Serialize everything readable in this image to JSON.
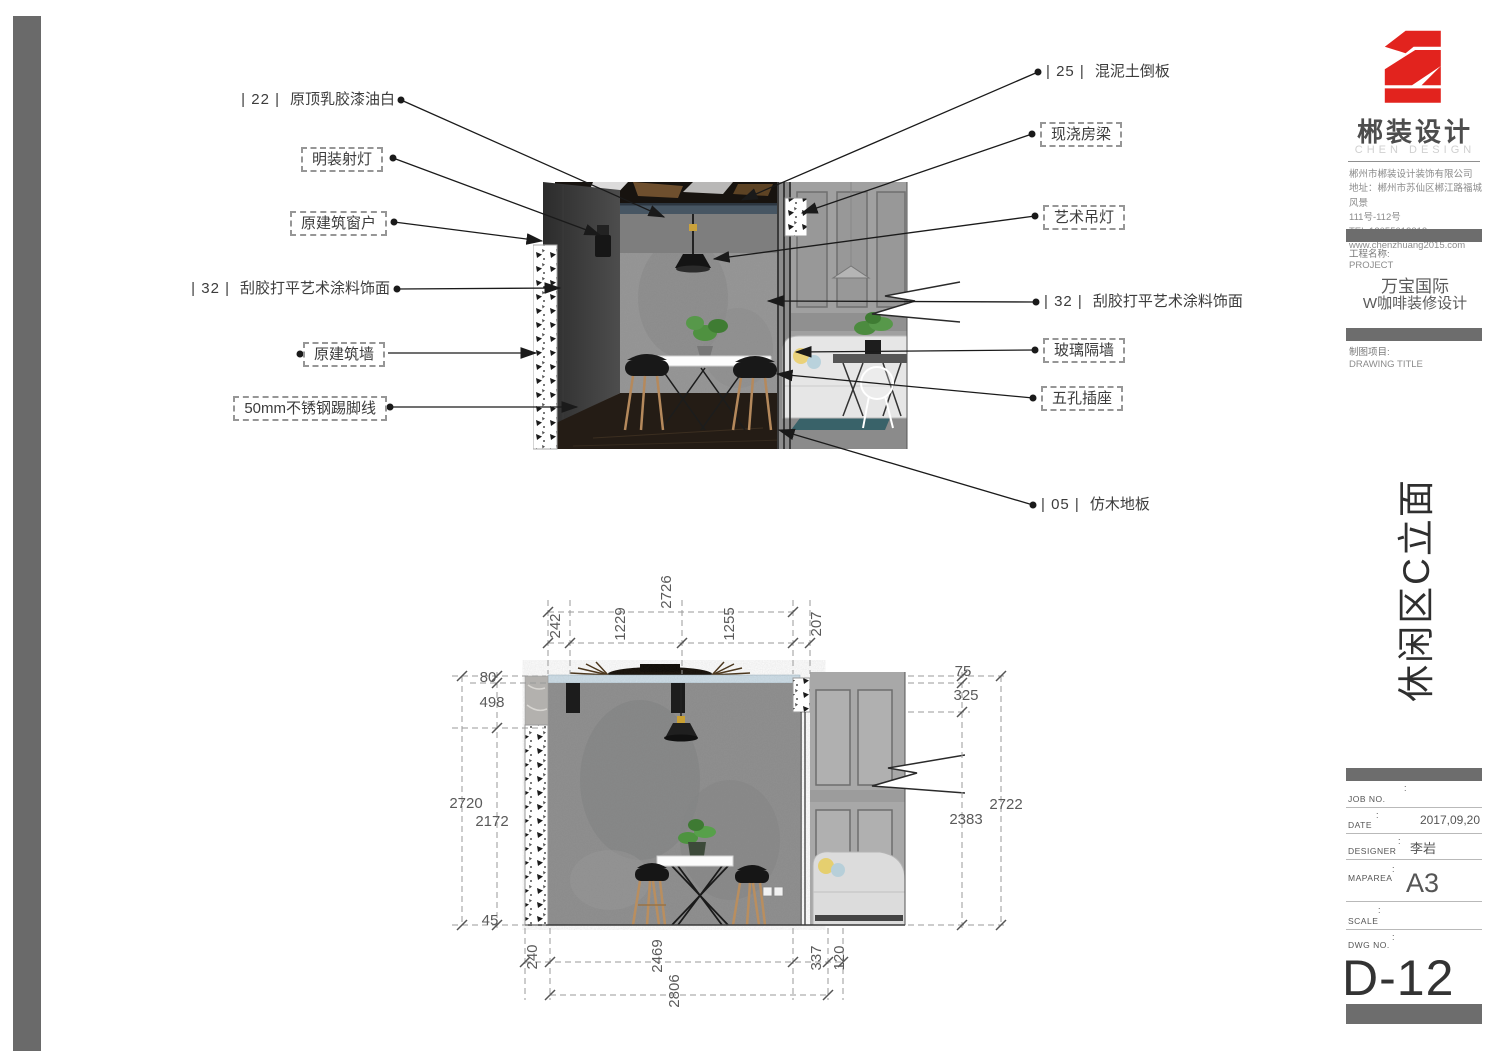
{
  "brand": {
    "name": "郴装设计",
    "subtitle": "CHEN DESIGN",
    "company_line1": "郴州市郴装设计装饰有限公司",
    "company_line2": "地址：郴州市苏仙区郴江路福城风景",
    "company_line3": "111号-112号",
    "company_line4": "TEL:13055012312",
    "company_line5": "www.chenzhuang2015.com"
  },
  "project": {
    "label": "工程名称:",
    "label_en": "PROJECT",
    "name_line1": "万宝国际",
    "name_line2": "W咖啡装修设计",
    "drawing_label": "制图项目:",
    "drawing_label_en": "DRAWING TITLE",
    "sheet_title": "休闲区C立面"
  },
  "titleblock": {
    "colon": ":",
    "job_no_label": "JOB NO.",
    "date_label": "DATE",
    "date_value": "2017,09,20",
    "designer_label": "DESIGNER",
    "designer_value": "李岩",
    "maparea_label": "MAPAREA",
    "maparea_value": "A3",
    "scale_label": "SCALE",
    "dwg_label": "DWG NO.",
    "dwg_value": "D-12"
  },
  "annotations": {
    "left": [
      {
        "code": "| 22 |",
        "text": "原顶乳胶漆油白"
      },
      {
        "text": "明装射灯"
      },
      {
        "text": "原建筑窗户"
      },
      {
        "code": "| 32 |",
        "text": "刮胶打平艺术涂料饰面"
      },
      {
        "text": "原建筑墙"
      },
      {
        "text": "50mm不锈钢踢脚线"
      }
    ],
    "right": [
      {
        "code": "| 25 |",
        "text": "混泥土倒板"
      },
      {
        "text": "现浇房梁"
      },
      {
        "text": "艺术吊灯"
      },
      {
        "code": "| 32 |",
        "text": "刮胶打平艺术涂料饰面"
      },
      {
        "text": "玻璃隔墙"
      },
      {
        "text": "五孔插座"
      },
      {
        "code": "| 05 |",
        "text": "仿木地板"
      }
    ]
  },
  "dimensions": {
    "top_total": "2726",
    "top_segments": [
      "242",
      "1229",
      "1255",
      "207"
    ],
    "left_outer": "2720",
    "left_segments": [
      "80",
      "498",
      "2172",
      "45"
    ],
    "right_outer": "2722",
    "right_segments": [
      "75",
      "325",
      "2383"
    ],
    "bottom_total": "2806",
    "bottom_segments": [
      "240",
      "2469",
      "337",
      "120"
    ]
  },
  "colors": {
    "brand_red": "#e2231e",
    "bar_gray": "#6d6d6d",
    "leader_black": "#1a1a1a",
    "dim_gray": "#9a9a9a",
    "concrete_gray": "#909090",
    "panel_gray": "#a8a8a8",
    "beam_blue": "#cfdfe9"
  }
}
